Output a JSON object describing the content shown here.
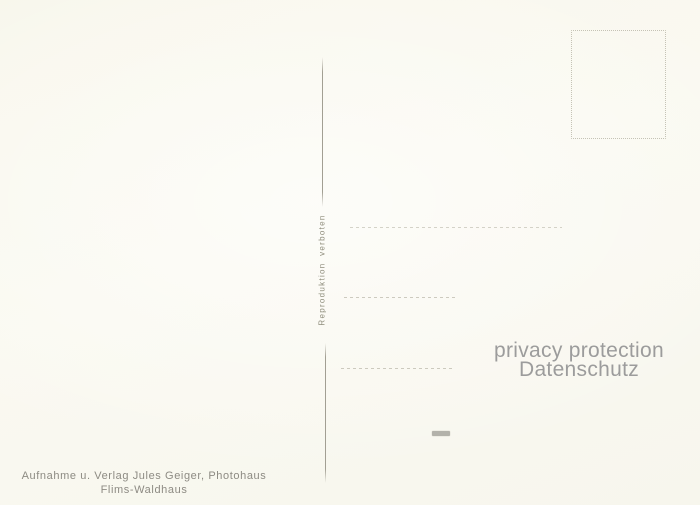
{
  "document_type": "postcard-back-scan",
  "publisher": {
    "line1": "Aufnahme u. Verlag Jules Geiger, Photohaus",
    "line2": "Flims-Waldhaus"
  },
  "notice": {
    "text": "Reproduktion verboten"
  },
  "privacy_overlay": {
    "line1": "privacy protection",
    "line2": "Datenschutz"
  },
  "colors": {
    "paper": "#faf9f1",
    "ink": "#8d8b83",
    "ink_light": "#8f8d7c",
    "faint_line": "#b4b1a2",
    "divider": "#a29f93",
    "overlay": "#9c9c9c",
    "smudge": "#a8a69f"
  }
}
